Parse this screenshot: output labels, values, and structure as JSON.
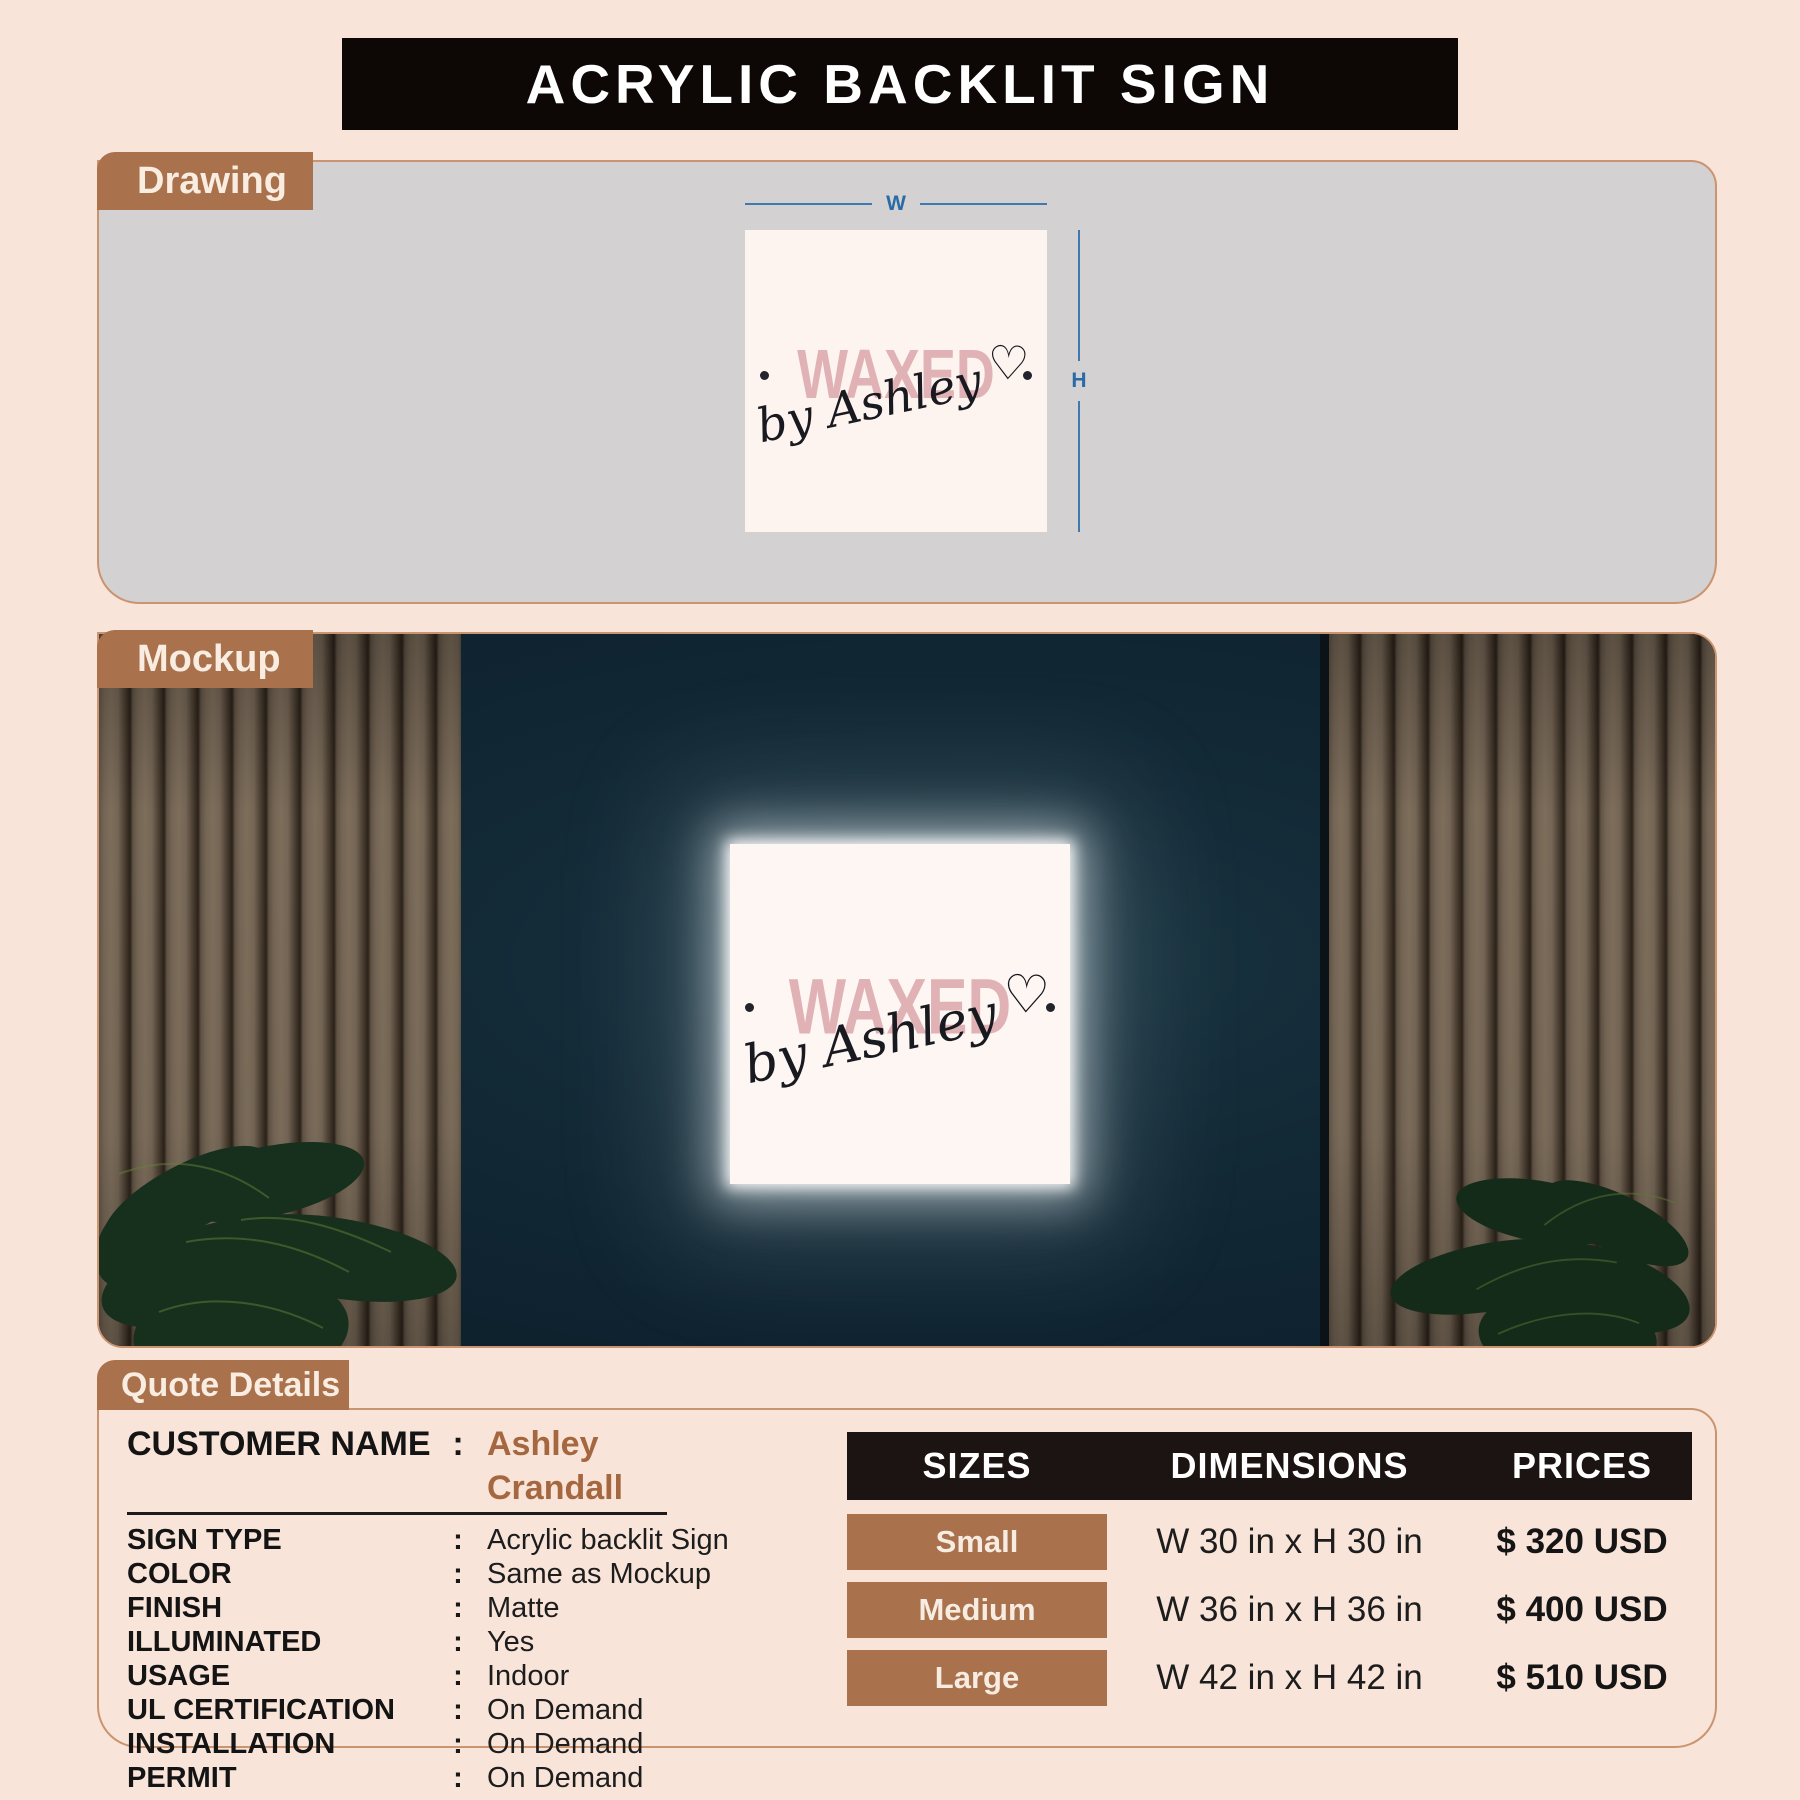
{
  "page": {
    "title": "ACRYLIC BACKLIT SIGN"
  },
  "sections": {
    "drawing_tab": "Drawing",
    "mockup_tab": "Mockup",
    "quote_tab": "Quote Details"
  },
  "dimension_labels": {
    "width": "W",
    "height": "H"
  },
  "sign": {
    "word": "WAXED",
    "script": "by Ashley",
    "heart_glyph": "♡"
  },
  "quote_details": {
    "customer_label": "CUSTOMER NAME",
    "colon": ":",
    "customer_value": "Ashley Crandall",
    "rows": [
      {
        "label": "SIGN TYPE",
        "value": "Acrylic backlit Sign"
      },
      {
        "label": "COLOR",
        "value": "Same as Mockup"
      },
      {
        "label": "FINISH",
        "value": "Matte"
      },
      {
        "label": "ILLUMINATED",
        "value": "Yes"
      },
      {
        "label": "USAGE",
        "value": "Indoor"
      },
      {
        "label": "UL CERTIFICATION",
        "value": "On Demand"
      },
      {
        "label": "INSTALLATION",
        "value": "On Demand"
      },
      {
        "label": "PERMIT",
        "value": "On Demand"
      }
    ]
  },
  "pricing_table": {
    "headers": {
      "sizes": "SIZES",
      "dimensions": "DIMENSIONS",
      "prices": "PRICES"
    },
    "rows": [
      {
        "size": "Small",
        "dimensions": "W 30 in x H 30 in",
        "price": "$ 320 USD"
      },
      {
        "size": "Medium",
        "dimensions": "W 36 in x H 36 in",
        "price": "$ 400 USD"
      },
      {
        "size": "Large",
        "dimensions": "W 42 in x H 42 in",
        "price": "$ 510 USD"
      }
    ]
  },
  "colors": {
    "background": "#f8e4d9",
    "header_black": "#0d0806",
    "accent_brown": "#a9714c",
    "panel_border": "#c9946f",
    "drawing_panel_gray": "#d3d1d2",
    "dimension_blue": "#2a6ba6",
    "sign_background": "#fdf4f0",
    "logo_pink": "#e0b2b5",
    "mockup_wall": "#122835",
    "customer_value_brown": "#a5673f",
    "table_header_black": "#1b1412"
  }
}
